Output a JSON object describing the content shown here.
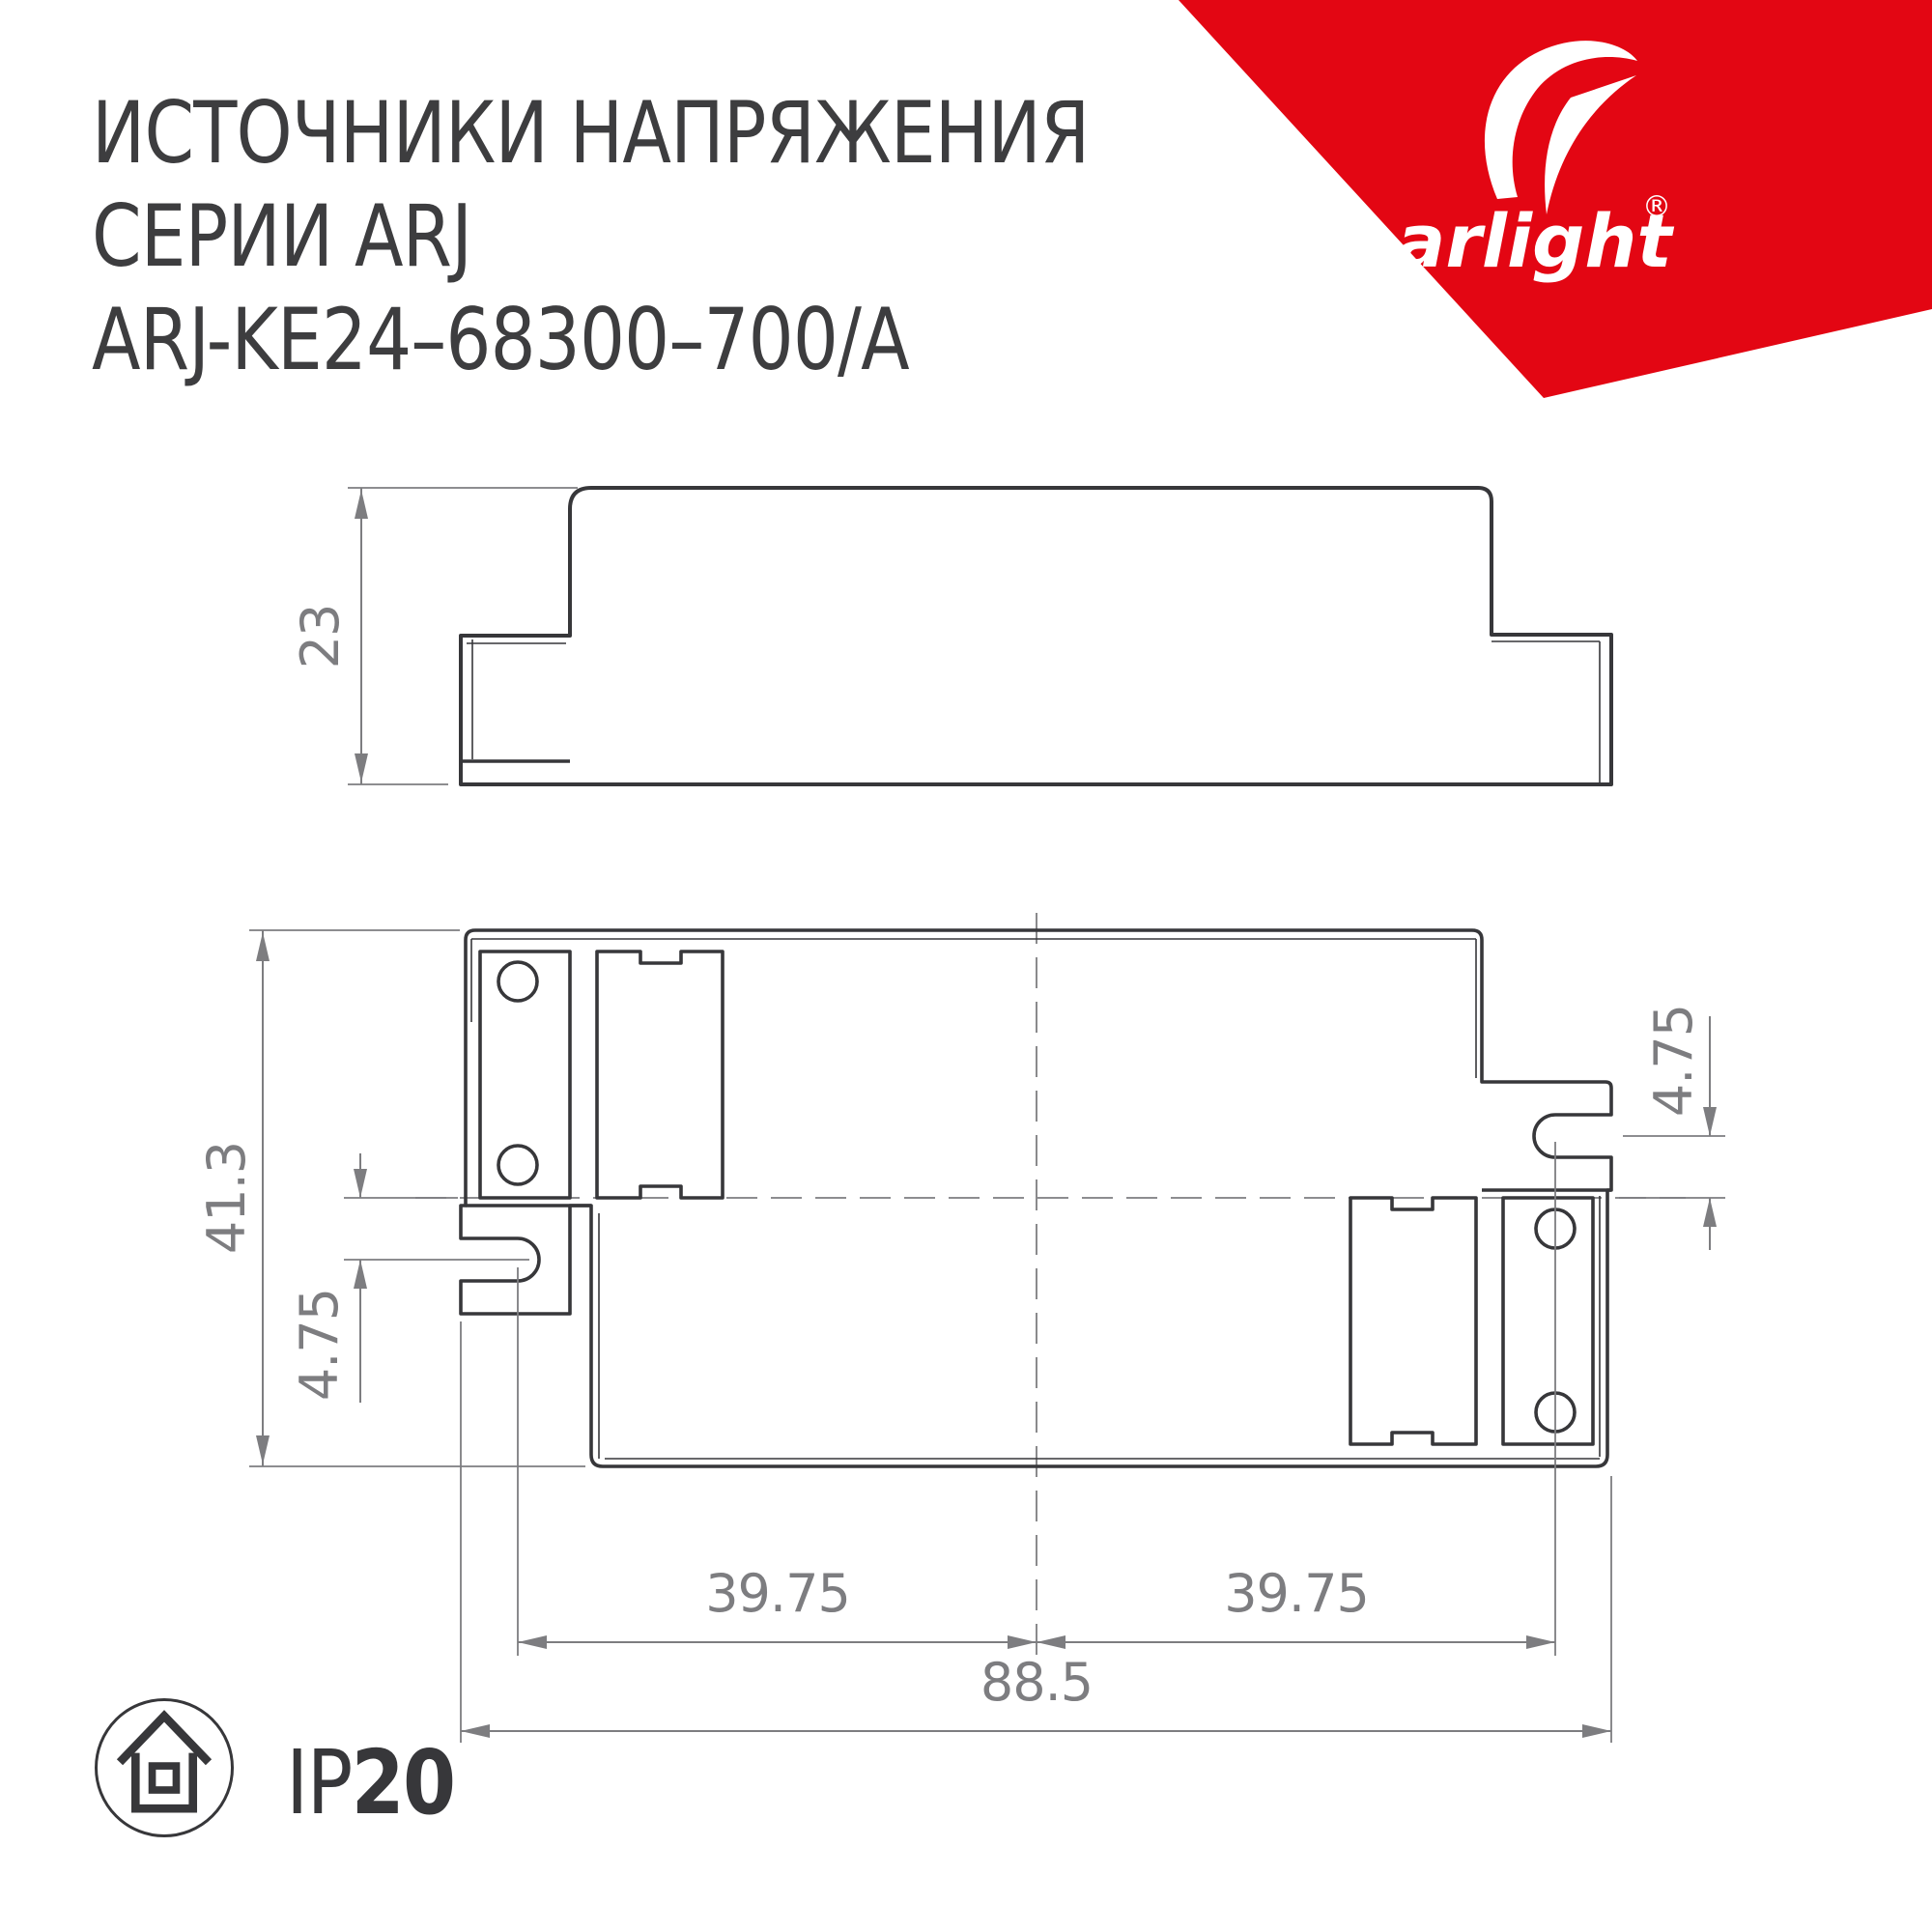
{
  "header": {
    "title_line1": "ИСТОЧНИКИ НАПРЯЖЕНИЯ",
    "title_line2": "СЕРИИ ARJ",
    "title_line3": "ARJ-KE24–68300–700/A"
  },
  "logo": {
    "brand": "arlight",
    "registered_mark": "®"
  },
  "drawing": {
    "side_view": {
      "dim_height": "23"
    },
    "bottom_view": {
      "dim_overall_height": "41.3",
      "dim_slot_offset_left": "4.75",
      "dim_slot_offset_right": "4.75",
      "dim_mount_span_left": "39.75",
      "dim_mount_span_right": "39.75",
      "dim_overall_width": "88.5"
    }
  },
  "footer": {
    "ip_prefix": "IP",
    "ip_value": "20"
  },
  "colors": {
    "brand-red": "#e30613",
    "line": "#37373a",
    "dim": "#7d7d80",
    "text": "#3d3d3f"
  }
}
